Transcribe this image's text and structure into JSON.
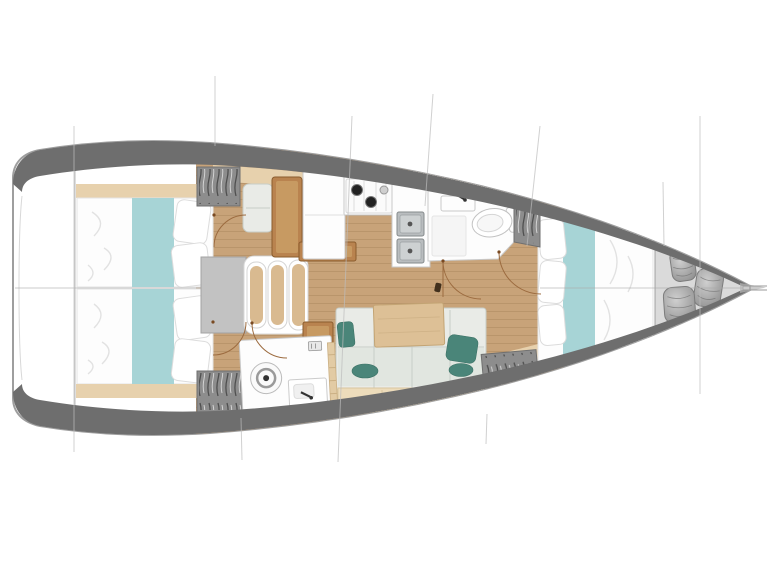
{
  "diagram": {
    "type": "sailing-yacht-interior-floor-plan",
    "view": "top-down",
    "orientation": "bow-right",
    "aria_label": "Sailing yacht interior layout plan, top-down view, bow pointing right"
  },
  "areas": [
    "transom",
    "aft-cabin-port",
    "aft-cabin-starboard",
    "companionway",
    "nav-station",
    "galley",
    "aft-head",
    "salon-dinette",
    "forward-head",
    "forward-cabin",
    "bow-locker"
  ],
  "counts": {
    "double_berths": 3,
    "heads": 2,
    "companionway_steps": 3,
    "stove_burners": 3,
    "galley_sinks": 2,
    "bow_fenders": 3,
    "salon_teal_cushions": 4
  },
  "colors": {
    "hull_outline": "#9e9e9e",
    "gunwale": "#6e6e6e",
    "floor_wood": "#c8a379",
    "shelf_beige": "#e7d1ad",
    "furniture_wood": "#b9834f",
    "furniture_wood_dark": "#8a5c2e",
    "furniture_wood_light": "#c79a62",
    "table_wood": "#ddc096",
    "runner_teal": "#a7d4d6",
    "pillow_teal": "#4a8579",
    "cushion": "#e9ebe7",
    "cushion_seat": "#dfe5de",
    "bench": "#eddcbb",
    "locker_gray": "#8d8d8d",
    "fixture_border": "#c9c9c9",
    "steel": "#b9bdbf",
    "step_tread": "#d9ba90",
    "landing_gray": "#c2c2c2",
    "line": "#bdbdbd",
    "arc_brown": "#9c6b3f",
    "fender": "#9c9c9c"
  }
}
